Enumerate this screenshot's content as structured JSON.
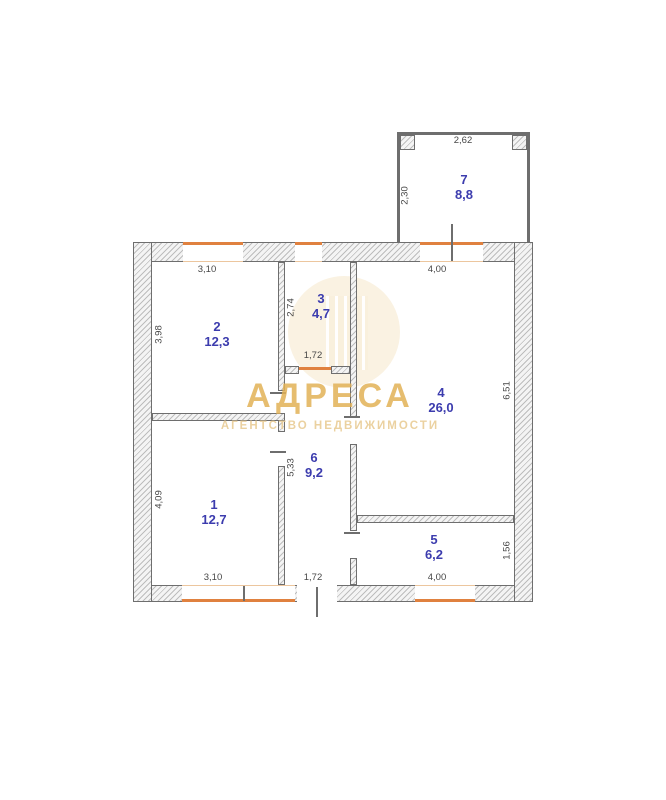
{
  "watermark": {
    "brand": "АДРЕСА",
    "subtitle": "АГЕНТСТВО НЕДВИЖИМОСТИ"
  },
  "colors": {
    "room_label": "#3c3cae",
    "dimension_text": "#474747",
    "window_accent": "#e0813f",
    "wall_line": "#6e6e6e",
    "watermark_gold": "#e2b257"
  },
  "plan": {
    "rooms": {
      "r1": {
        "number": "1",
        "area": "12,7"
      },
      "r2": {
        "number": "2",
        "area": "12,3"
      },
      "r3": {
        "number": "3",
        "area": "4,7"
      },
      "r4": {
        "number": "4",
        "area": "26,0"
      },
      "r5": {
        "number": "5",
        "area": "6,2"
      },
      "r6": {
        "number": "6",
        "area": "9,2"
      },
      "r7": {
        "number": "7",
        "area": "8,8"
      }
    },
    "dims": {
      "room7_width": "2,62",
      "room7_depth": "2,30",
      "room2_width": "3,10",
      "room2_depth": "3,98",
      "room3_depth": "2,74",
      "room3_door": "1,72",
      "room4_width": "4,00",
      "room4_depth": "6,51",
      "room6_depth": "5,33",
      "room6_door": "1,72",
      "room1_depth": "4,09",
      "room1_width": "3,10",
      "room5_width": "4,00",
      "room5_depth": "1,56"
    }
  }
}
